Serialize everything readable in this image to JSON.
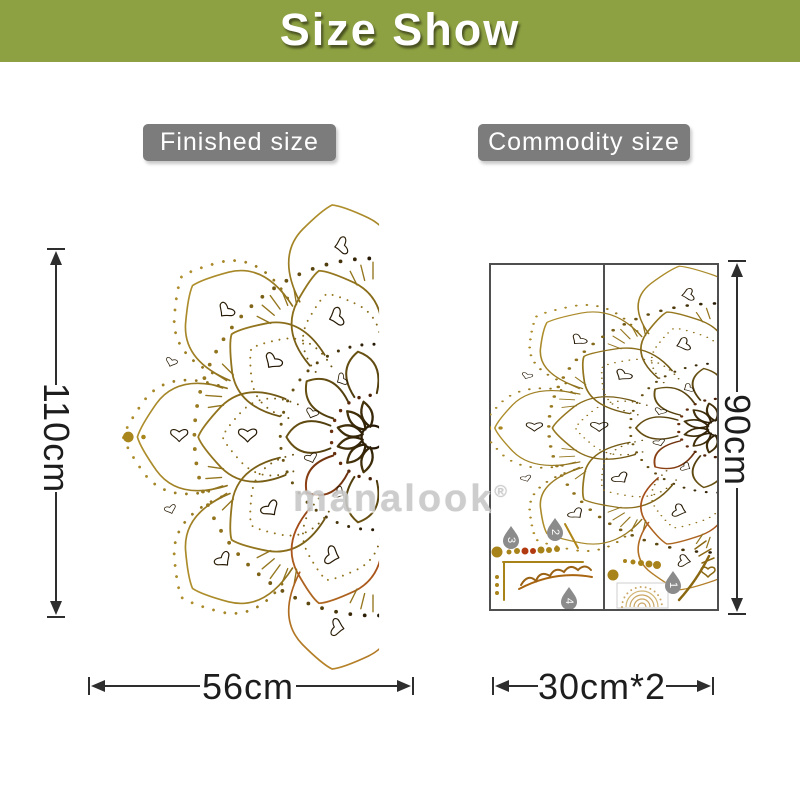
{
  "banner": {
    "title": "Size Show",
    "bg_color": "#8da142",
    "text_color": "#ffffff"
  },
  "finished": {
    "tag": "Finished size",
    "height": "110cm",
    "width": "56cm"
  },
  "commodity": {
    "tag": "Commodity size",
    "height": "90cm",
    "width": "30cm*2"
  },
  "tag_bg_color": "#7c7c7c",
  "watermark": {
    "text": "manalook",
    "reg": "®"
  },
  "sheet": {
    "numbers": [
      "1",
      "2",
      "3",
      "4"
    ]
  },
  "art_colors": {
    "gold": "#b0891e",
    "olive": "#7a5c12",
    "dark_brown": "#241704",
    "rust": "#a84e1a",
    "dimension_line": "#2e2e2e",
    "panel_border": "#4f4f4f",
    "watermark_gray": "#c8c8c8"
  }
}
